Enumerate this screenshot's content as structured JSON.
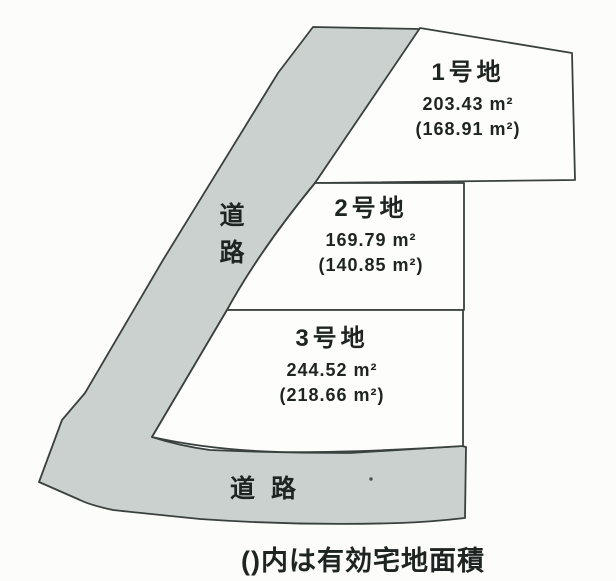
{
  "diagram": {
    "caption": "()内は有効宅地面積",
    "roads": {
      "left": {
        "label": "道路"
      },
      "bottom": {
        "label": "道路"
      }
    },
    "lots": [
      {
        "name": "1号地",
        "area": "203.43 m²",
        "effective_area": "(168.91 m²)"
      },
      {
        "name": "2号地",
        "area": "169.79 m²",
        "effective_area": "(140.85 m²)"
      },
      {
        "name": "3号地",
        "area": "244.52 m²",
        "effective_area": "(218.66 m²)"
      }
    ],
    "colors": {
      "road_fill": "#cad1ce",
      "outline": "#39413f",
      "plot_fill": "#fdfdfc",
      "background": "#fcfcfb",
      "text": "#1d2422"
    }
  }
}
